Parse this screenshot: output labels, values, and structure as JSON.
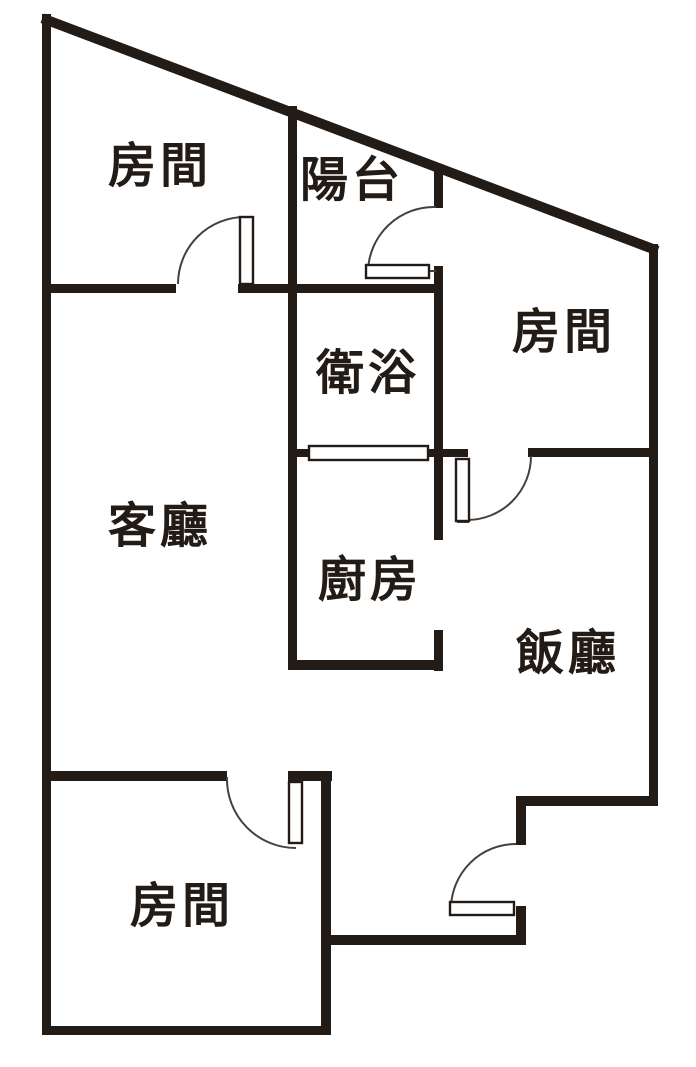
{
  "title": "apartment-floor-plan",
  "colors": {
    "wall": "#221b16",
    "thin_line": "#46403a",
    "background": "#ffffff",
    "door_fill": "#ffffff"
  },
  "rooms": {
    "bedroom_top_left": {
      "label": "房間"
    },
    "balcony": {
      "label": "陽台"
    },
    "bedroom_right": {
      "label": "房間"
    },
    "bathroom": {
      "label": "衛浴"
    },
    "living_room": {
      "label": "客廳"
    },
    "kitchen": {
      "label": "廚房"
    },
    "dining_room": {
      "label": "飯廳"
    },
    "bedroom_bottom": {
      "label": "房間"
    }
  }
}
